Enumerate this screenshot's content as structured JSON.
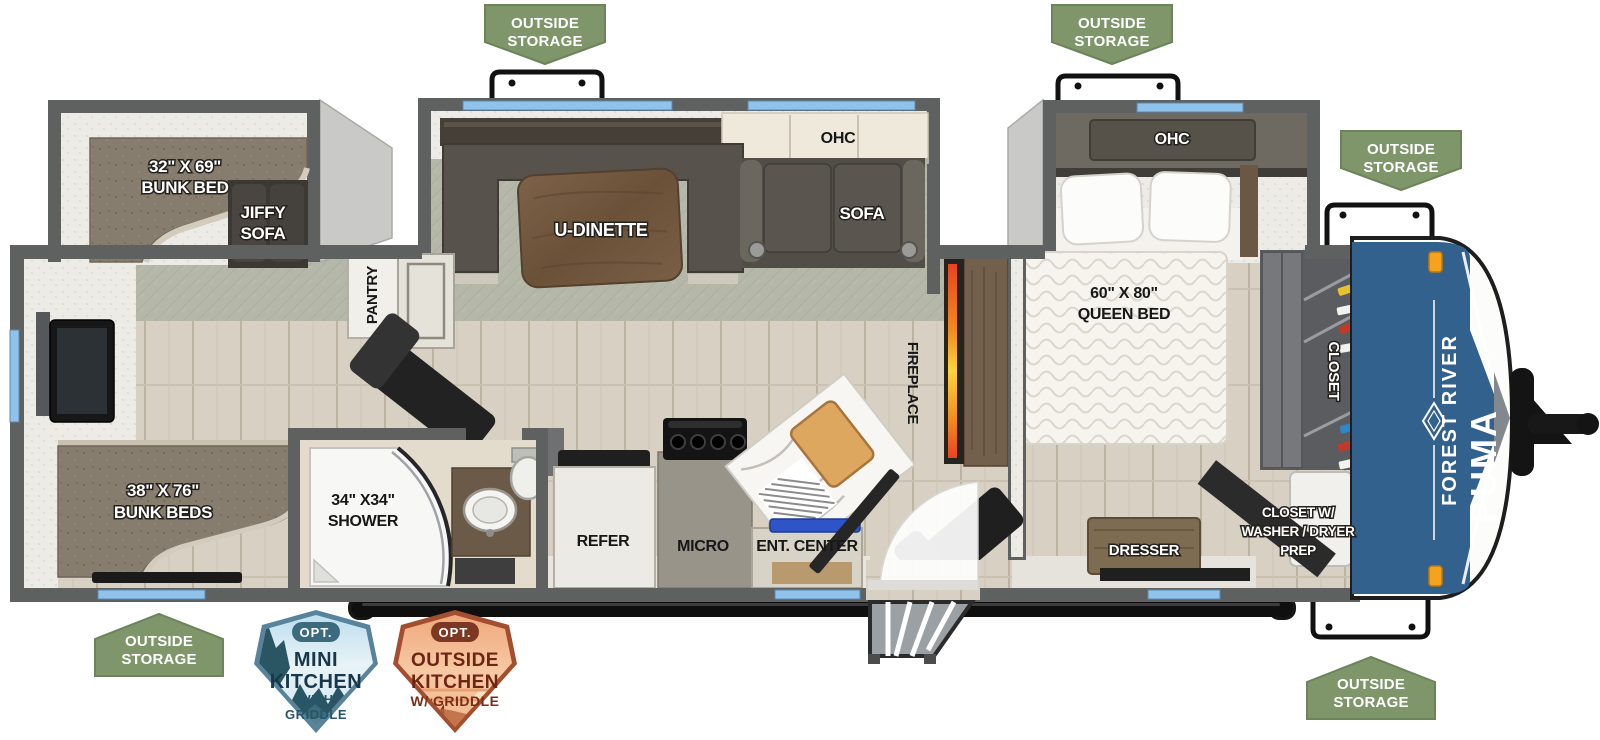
{
  "badges": {
    "outside_storage": {
      "line1": "OUTSIDE",
      "line2": "STORAGE"
    }
  },
  "rooms": {
    "bunk_over_sofa": {
      "size": "32\" X 69\"",
      "name": "BUNK BED"
    },
    "jiffy_sofa": {
      "line1": "JIFFY",
      "line2": "SOFA"
    },
    "ohc": "OHC",
    "u_dinette": "U-DINETTE",
    "sofa": "SOFA",
    "queen_bed": {
      "size": "60\" X 80\"",
      "name": "QUEEN BED"
    },
    "pantry": "PANTRY",
    "fireplace": "FIREPLACE",
    "shower": {
      "size": "34\" X34\"",
      "name": "SHOWER"
    },
    "refer": "REFER",
    "micro": "MICRO",
    "ent_center": "ENT. CENTER",
    "bunk_beds": {
      "size": "38\" X 76\"",
      "name": "BUNK BEDS"
    },
    "closet": "CLOSET",
    "washer_dryer_closet": {
      "line1": "CLOSET W/",
      "line2": "WASHER / DRYER",
      "line3": "PREP"
    },
    "dresser": "DRESSER"
  },
  "front_cap": {
    "brand": "FOREST RIVER",
    "model": "PUMA"
  },
  "option_badges": {
    "mini_kitchen": {
      "opt": "OPT.",
      "line1": "MINI",
      "line2": "KITCHEN",
      "line3": "WITH",
      "line4": "GRIDDLE"
    },
    "outside_kitchen": {
      "opt": "OPT.",
      "line1": "OUTSIDE",
      "line2": "KITCHEN",
      "line3": "W/ GRIDDLE"
    }
  },
  "colors": {
    "badge_green": "#7E9669",
    "cap_blue": "#33618E",
    "window_blue": "#8FC3EC",
    "flame_orange": "#F26A1B",
    "wall_gray": "#5F6060",
    "carpet_green": "#B5B8A8",
    "mini_kitchen_teal": "#57839C",
    "outside_kitchen_orange": "#A34E2F"
  }
}
